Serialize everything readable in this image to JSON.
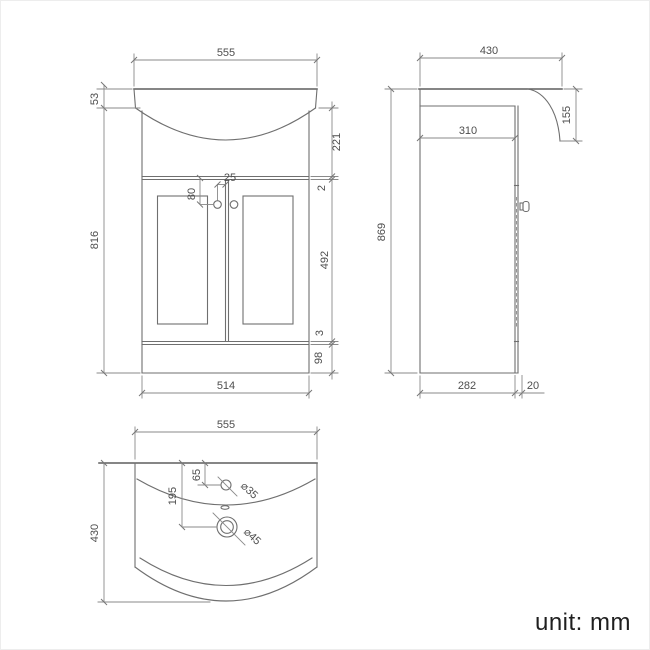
{
  "style": {
    "background": "#ffffff",
    "line_color": "#6f6f6f",
    "dimension_line_color": "#8a8a8a",
    "text_color": "#4e4e4e"
  },
  "unit_label": "unit: mm",
  "front_view": {
    "dims": {
      "basin_width": "555",
      "basin_lip_height": "53",
      "cabinet_height": "816",
      "upper_panel_height": "221",
      "door_top_gap": "2",
      "door_height": "492",
      "door_bottom_gap": "3",
      "plinth_height": "98",
      "cabinet_width": "514",
      "handle_drop": "80",
      "handle_inset": "25"
    }
  },
  "side_view": {
    "dims": {
      "overall_depth": "430",
      "basin_front_height": "155",
      "worktop_depth": "310",
      "overall_height": "869",
      "cabinet_depth": "282",
      "door_thickness": "20"
    }
  },
  "top_view": {
    "dims": {
      "basin_width": "555",
      "basin_depth": "430",
      "tap_hole_offset": "65",
      "waste_hole_offset": "195",
      "tap_hole_diameter": "⌀35",
      "waste_hole_diameter": "⌀45"
    }
  }
}
